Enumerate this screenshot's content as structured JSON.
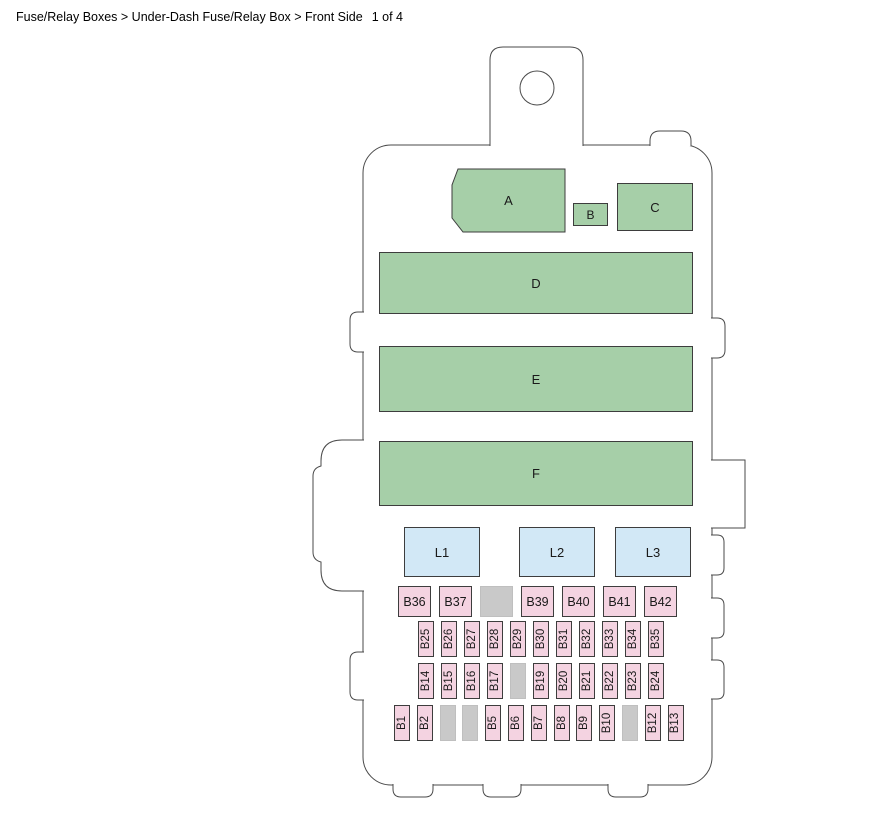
{
  "header": {
    "breadcrumb": "Fuse/Relay Boxes > Under-Dash Fuse/Relay Box > Front Side",
    "page_indicator": "1 of 4"
  },
  "colors": {
    "relay_green": "#a6cfa8",
    "connector_blue": "#d2e8f6",
    "fuse_pink": "#f4d3e1",
    "blank_gray": "#c9c9c9",
    "outline_gray": "#4a4a4a"
  },
  "diagram": {
    "top_blocks": [
      {
        "label": "A"
      },
      {
        "label": "B"
      },
      {
        "label": "C"
      }
    ],
    "wide_blocks": [
      {
        "label": "D"
      },
      {
        "label": "E"
      },
      {
        "label": "F"
      }
    ],
    "connector_blocks": [
      {
        "label": "L1"
      },
      {
        "label": "L2"
      },
      {
        "label": "L3"
      }
    ],
    "fuse_rows": [
      {
        "name": "row-b36-b42",
        "orientation": "horizontal",
        "cells": [
          "B36",
          "B37",
          "",
          "B39",
          "B40",
          "B41",
          "B42"
        ]
      },
      {
        "name": "row-b25-b35",
        "orientation": "vertical",
        "cells": [
          "B25",
          "B26",
          "B27",
          "B28",
          "B29",
          "B30",
          "B31",
          "B32",
          "B33",
          "B34",
          "B35"
        ]
      },
      {
        "name": "row-b14-b24",
        "orientation": "vertical",
        "cells": [
          "B14",
          "B15",
          "B16",
          "B17",
          "",
          "B19",
          "B20",
          "B21",
          "B22",
          "B23",
          "B24"
        ]
      },
      {
        "name": "row-b1-b13",
        "orientation": "vertical",
        "cells": [
          "B1",
          "B2",
          "",
          "",
          "B5",
          "B6",
          "B7",
          "B8",
          "B9",
          "B10",
          "",
          "B12",
          "B13"
        ]
      }
    ]
  }
}
